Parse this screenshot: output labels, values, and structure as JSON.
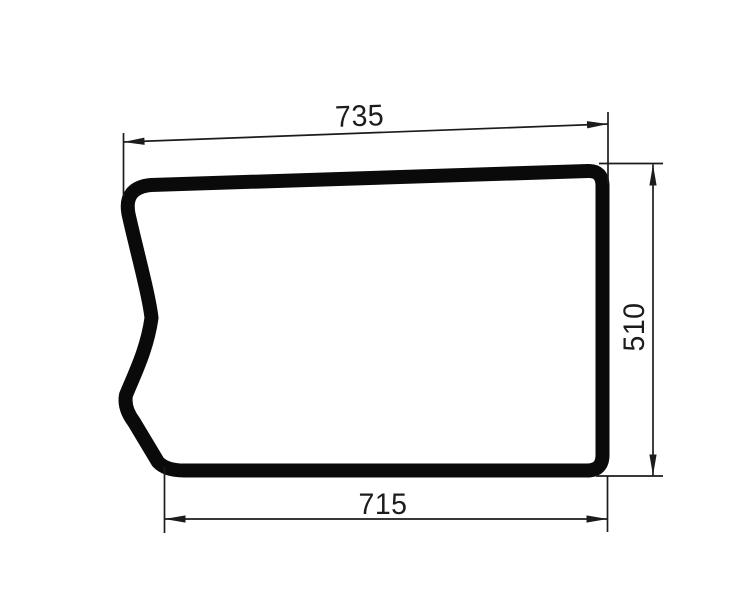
{
  "drawing": {
    "subject": "glass panel outline",
    "dimensions": {
      "top_width": "735",
      "right_height": "510",
      "bottom_width": "715"
    },
    "colors": {
      "outline": "#0a0a0a",
      "dimension": "#1c1c1c",
      "background": "#ffffff"
    }
  }
}
